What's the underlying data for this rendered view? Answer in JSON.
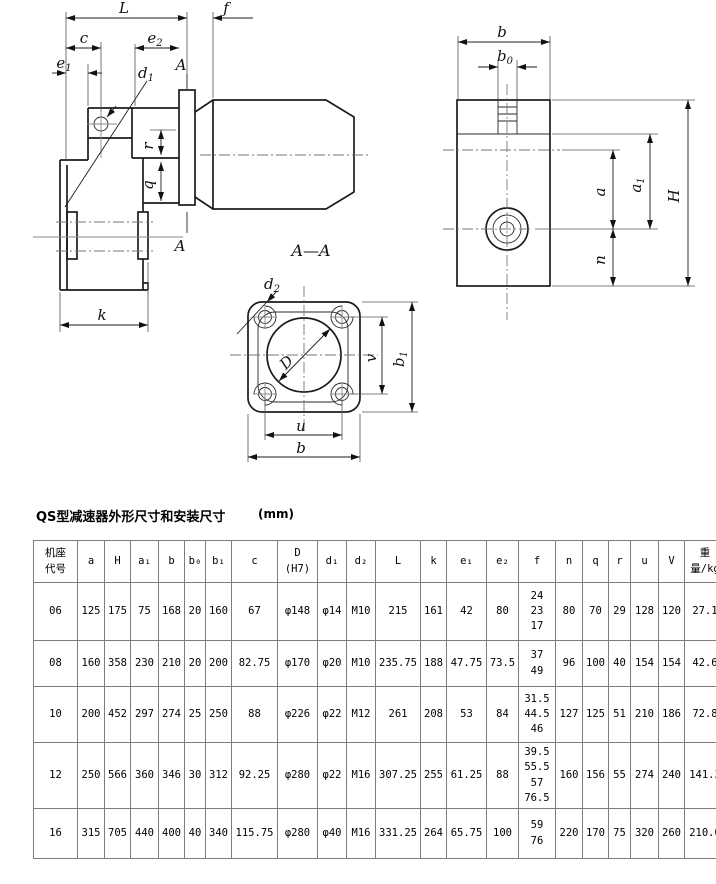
{
  "title": {
    "text": "QS型减速器外形尺寸和安装尺寸",
    "unit": "(mm)"
  },
  "drawing": {
    "side": {
      "L": {
        "t": "L"
      },
      "f": {
        "t": "f"
      },
      "c": {
        "t": "c"
      },
      "e2": {
        "t": "e",
        "s": "2"
      },
      "e1": {
        "t": "e",
        "s": "1"
      },
      "d1": {
        "t": "d",
        "s": "1"
      },
      "A_top": {
        "t": "A"
      },
      "A_bottom": {
        "t": "A"
      },
      "r": {
        "t": "r"
      },
      "q": {
        "t": "q"
      },
      "k": {
        "t": "k"
      }
    },
    "section": {
      "title": {
        "t": "A—A"
      },
      "d2": {
        "t": "d",
        "s": "2"
      },
      "D": {
        "t": "D"
      },
      "v": {
        "t": "v"
      },
      "b1": {
        "t": "b",
        "s": "1"
      },
      "u": {
        "t": "u"
      },
      "b": {
        "t": "b"
      }
    },
    "end": {
      "b": {
        "t": "b"
      },
      "b0": {
        "t": "b",
        "s": "0"
      },
      "a": {
        "t": "a"
      },
      "a1": {
        "t": "a",
        "s": "1"
      },
      "H": {
        "t": "H"
      },
      "n": {
        "t": "n"
      }
    }
  },
  "table": {
    "headers": [
      "机座\n代号",
      "a",
      "H",
      "a₁",
      "b",
      "b₀",
      "b₁",
      "c",
      "D\n(H7)",
      "d₁",
      "d₂",
      "L",
      "k",
      "e₁",
      "e₂",
      "f",
      "n",
      "q",
      "r",
      "u",
      "V",
      "重\n量/kg"
    ],
    "rows": [
      [
        "06",
        "125",
        "175",
        "75",
        "168",
        "20",
        "160",
        "67",
        "φ148",
        "φ14",
        "M10",
        "215",
        "161",
        "42",
        "80",
        "24\n23\n17",
        "80",
        "70",
        "29",
        "128",
        "120",
        "27.1"
      ],
      [
        "08",
        "160",
        "358",
        "230",
        "210",
        "20",
        "200",
        "82.75",
        "φ170",
        "φ20",
        "M10",
        "235.75",
        "188",
        "47.75",
        "73.5",
        "37\n49",
        "96",
        "100",
        "40",
        "154",
        "154",
        "42.6"
      ],
      [
        "10",
        "200",
        "452",
        "297",
        "274",
        "25",
        "250",
        "88",
        "φ226",
        "φ22",
        "M12",
        "261",
        "208",
        "53",
        "84",
        "31.5\n44.5\n46",
        "127",
        "125",
        "51",
        "210",
        "186",
        "72.8"
      ],
      [
        "12",
        "250",
        "566",
        "360",
        "346",
        "30",
        "312",
        "92.25",
        "φ280",
        "φ22",
        "M16",
        "307.25",
        "255",
        "61.25",
        "88",
        "39.5\n55.5\n57\n76.5",
        "160",
        "156",
        "55",
        "274",
        "240",
        "141.3"
      ],
      [
        "16",
        "315",
        "705",
        "440",
        "400",
        "40",
        "340",
        "115.75",
        "φ280",
        "φ40",
        "M16",
        "331.25",
        "264",
        "65.75",
        "100",
        "59\n76",
        "220",
        "170",
        "75",
        "320",
        "260",
        "210.0"
      ]
    ]
  }
}
